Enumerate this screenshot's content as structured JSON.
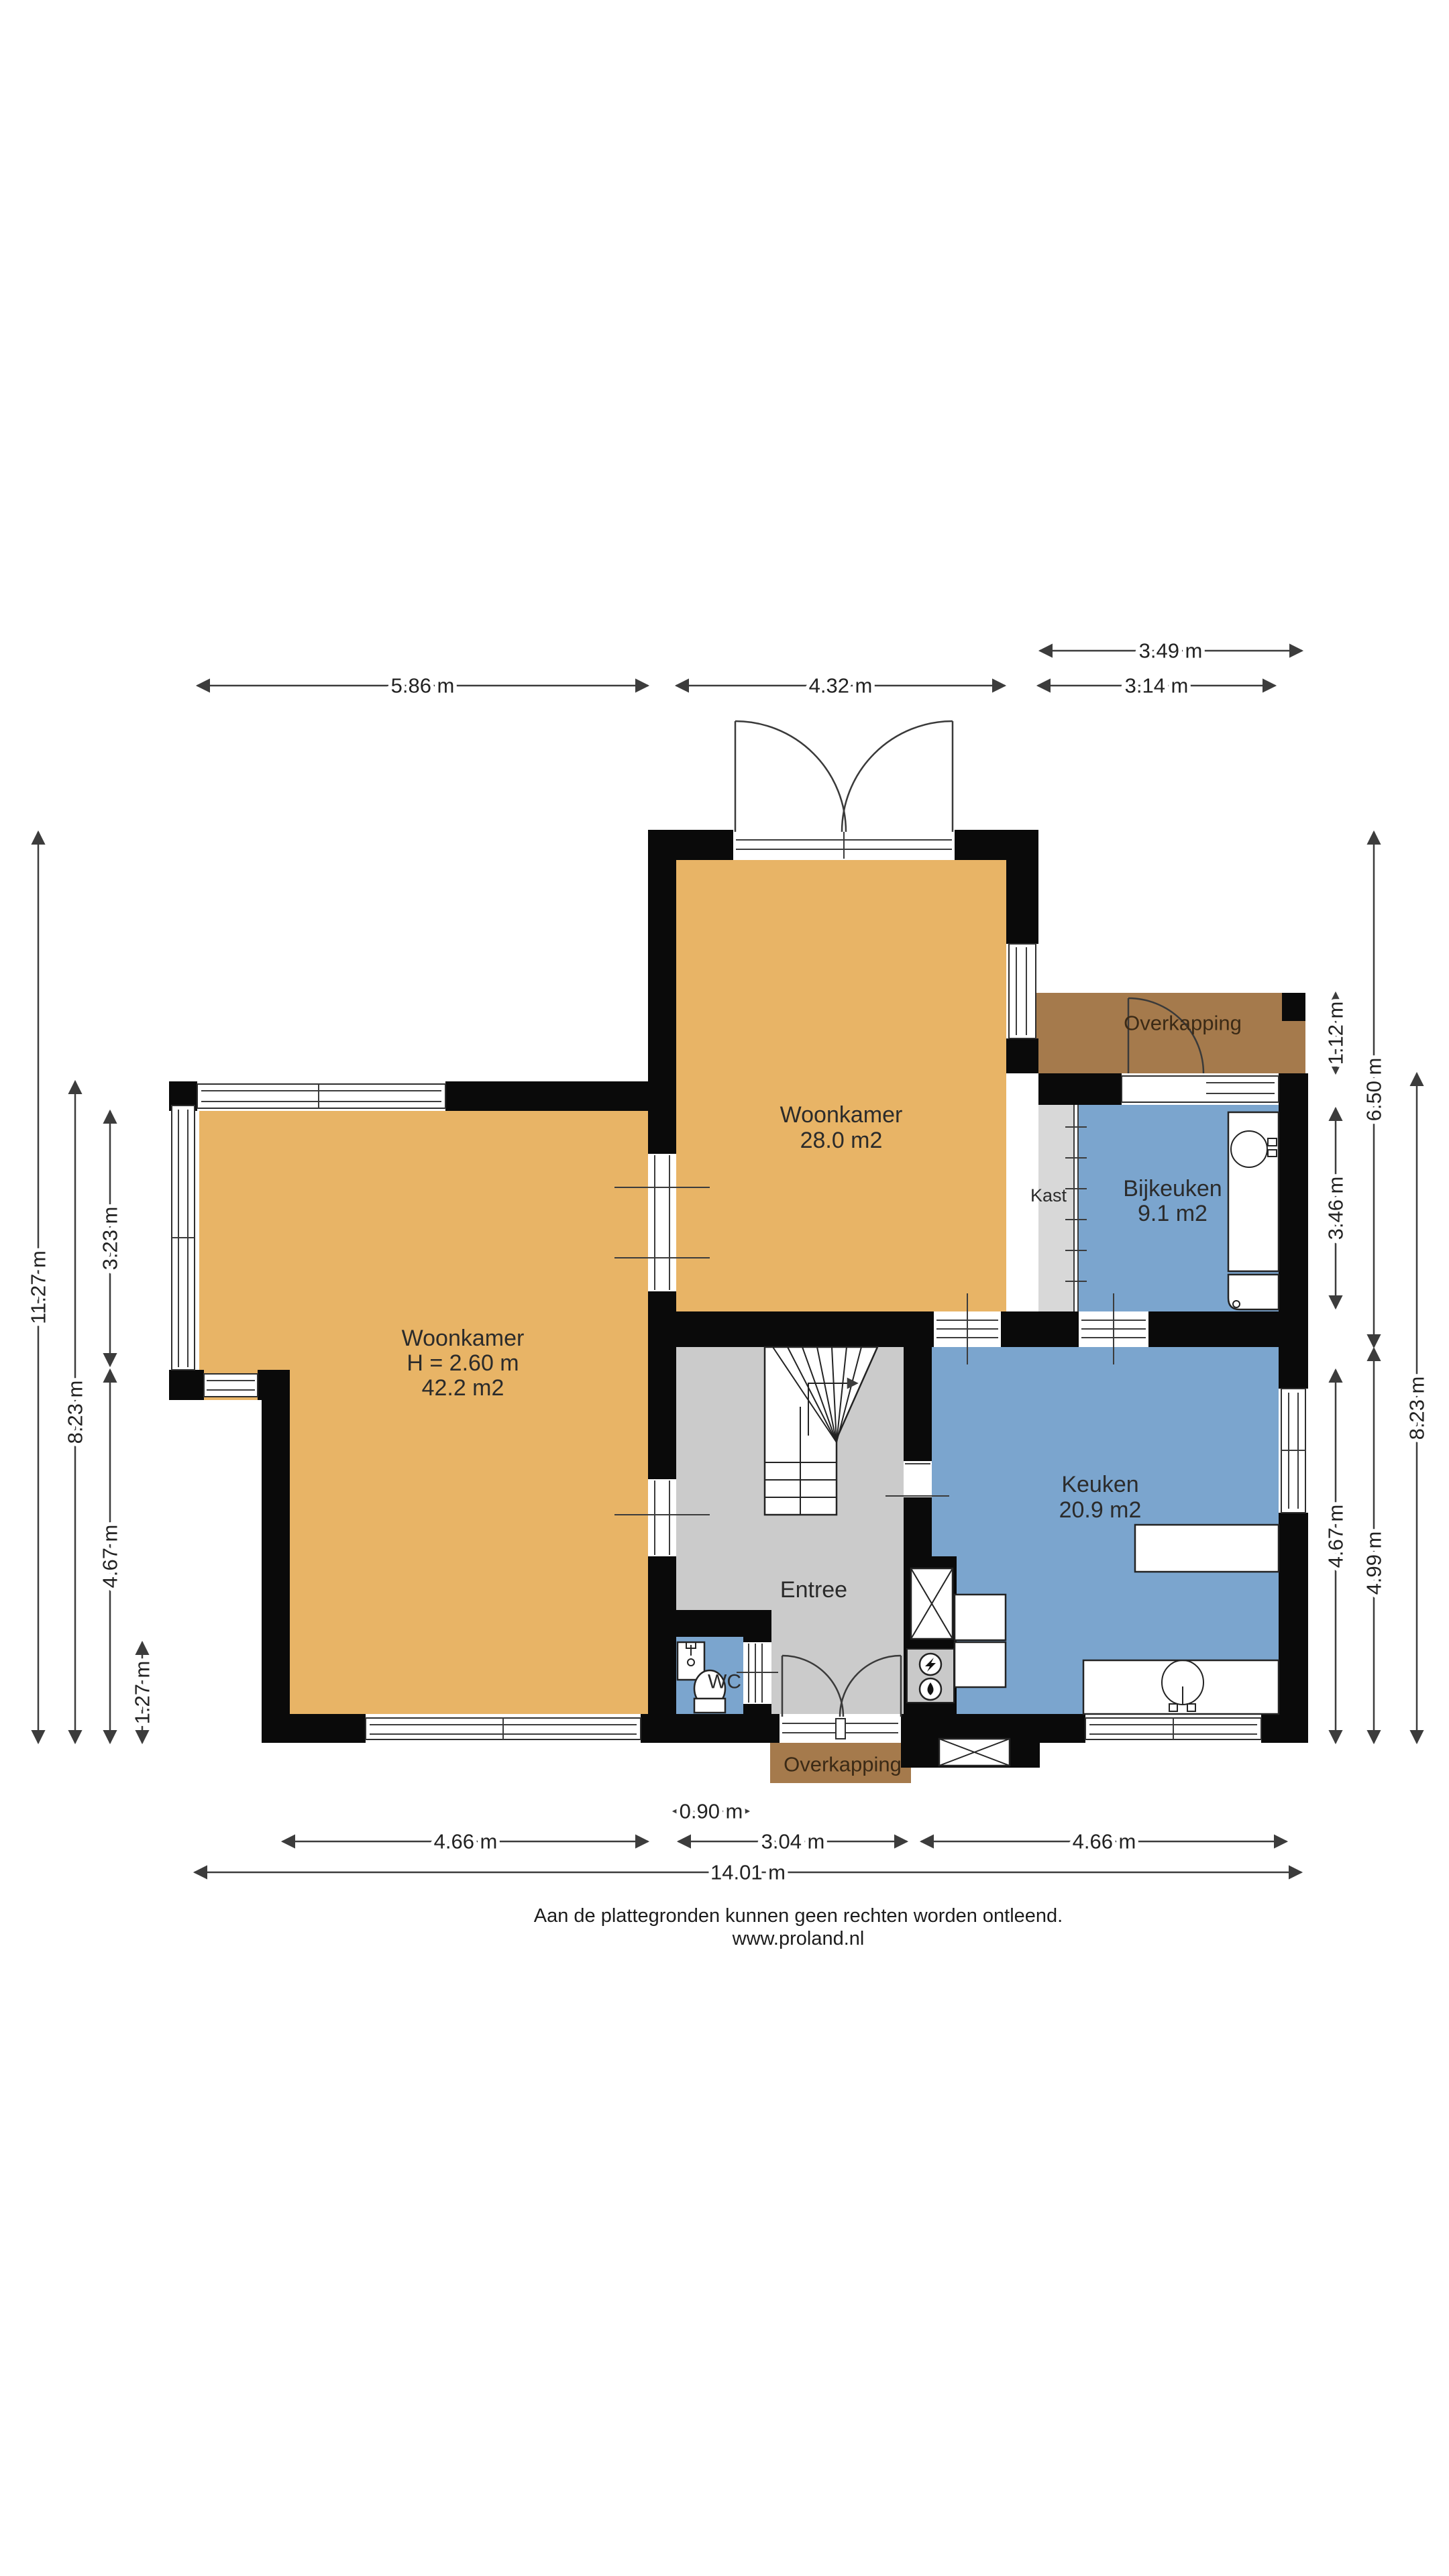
{
  "plan": {
    "colors": {
      "page_bg": "#FFFFFF",
      "floor_orange": "#E8B466",
      "floor_blue": "#7BA5CE",
      "floor_gray": "#CBCBCB",
      "closet_gray": "#D8D8D8",
      "canopy_brown": "#A57A4C",
      "wall": "#0A0A0A",
      "line": "#3C3C3C",
      "text": "#222222"
    },
    "rooms": {
      "woonkamer_top": {
        "label": "Woonkamer",
        "area": "28.0 m2"
      },
      "woonkamer_left": {
        "label": "Woonkamer",
        "ceiling_height": "H = 2.60 m",
        "area": "42.2 m2"
      },
      "bijkeuken": {
        "label": "Bijkeuken",
        "area": "9.1 m2"
      },
      "keuken": {
        "label": "Keuken",
        "area": "20.9 m2"
      },
      "entree": {
        "label": "Entree"
      },
      "wc": {
        "label": "WC"
      },
      "kast": {
        "label": "Kast"
      },
      "overkapping_top": {
        "label": "Overkapping"
      },
      "overkapping_bottom": {
        "label": "Overkapping"
      }
    },
    "dimensions": {
      "top": {
        "d1": "3.49 m",
        "d2": "5.86 m",
        "d3": "4.32 m",
        "d4": "3.14 m"
      },
      "left": {
        "d1": "11.27 m",
        "d2": "8.23 m",
        "d3": "3.23 m",
        "d4": "4.67 m",
        "d5": "1.27 m"
      },
      "right": {
        "d1": "1.12 m",
        "d2": "6.50 m",
        "d3": "3.46 m",
        "d4": "8.23 m",
        "d5": "4.67 m",
        "d6": "4.99 m"
      },
      "bottom": {
        "d1": "0.90 m",
        "d2": "4.66 m",
        "d3": "3.04 m",
        "d4": "4.66 m",
        "d5": "14.01 m"
      }
    }
  },
  "footer": {
    "line1": "Aan de plattegronden kunnen geen rechten worden ontleend.",
    "line2": "www.proland.nl"
  }
}
